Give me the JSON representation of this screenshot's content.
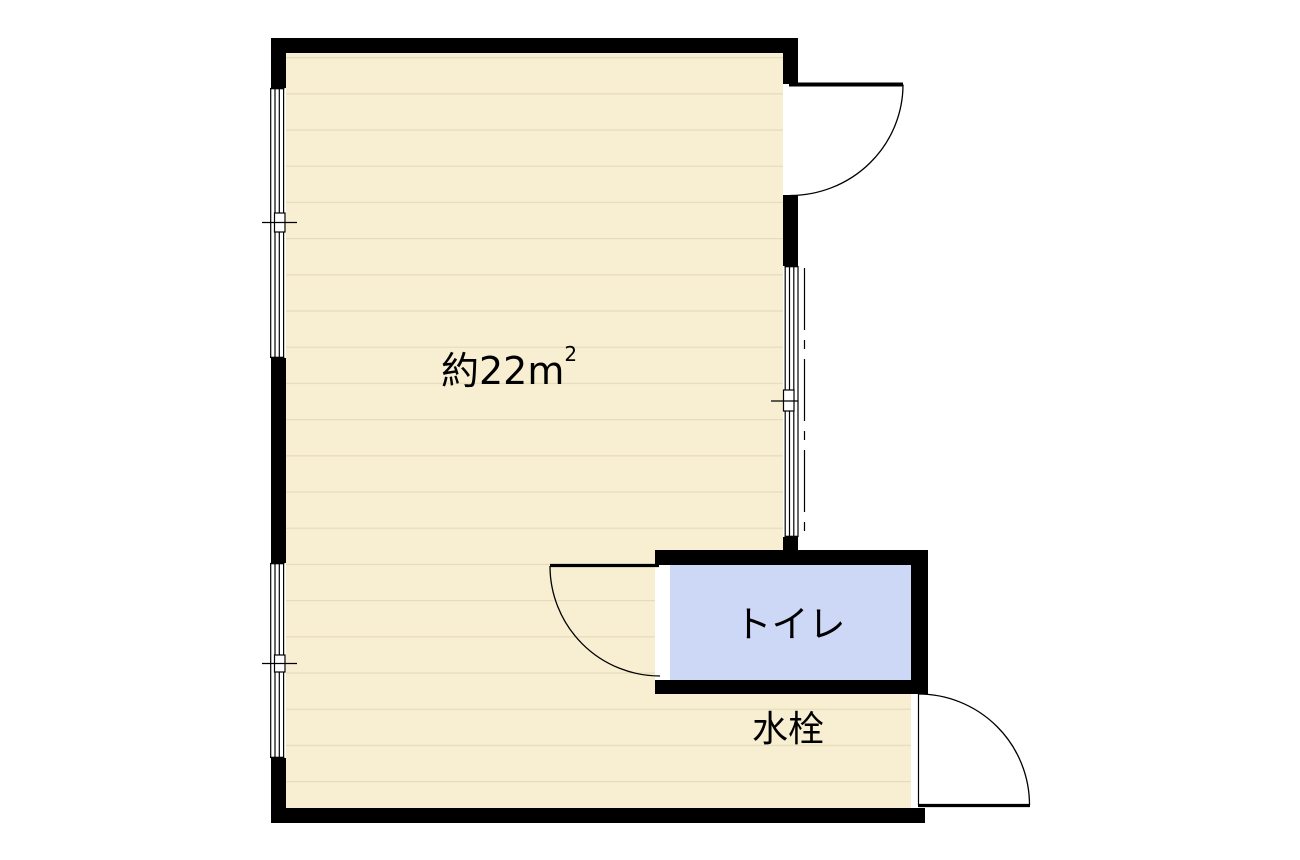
{
  "colors": {
    "background": "#ffffff",
    "wall": "#000000",
    "line": "#000000",
    "text": "#000000",
    "floor": "#f8efd2",
    "plank_line": "#e6dcba",
    "toilet_floor": "#cdd8f6"
  },
  "labels": {
    "area": {
      "text": "約22㎡",
      "base": "約22m",
      "sup": "2"
    },
    "toilet": "トイレ",
    "water_tap": "水栓"
  }
}
